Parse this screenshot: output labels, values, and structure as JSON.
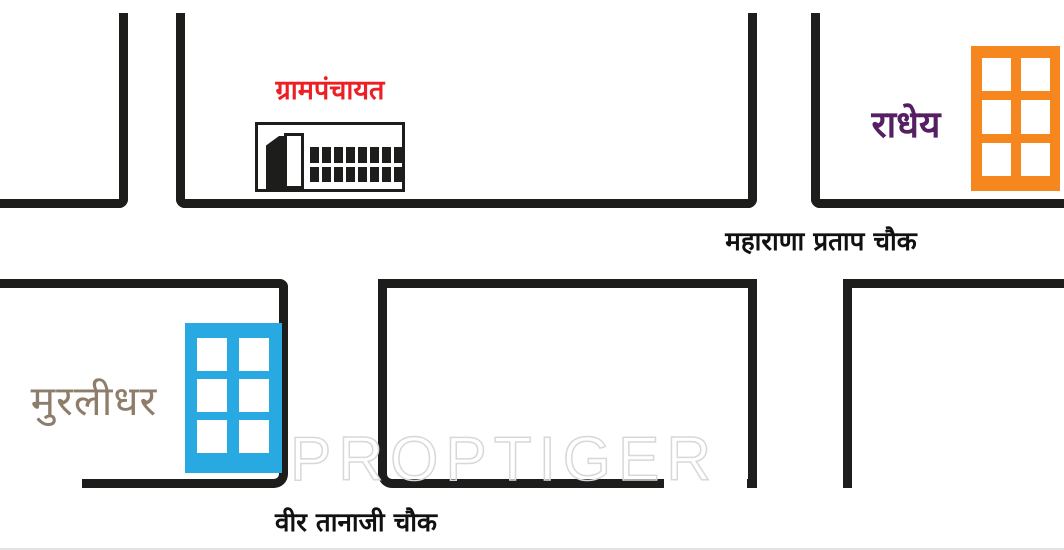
{
  "map": {
    "road_color": "#1d1d1b",
    "watermark": {
      "text": "PROPTIGER",
      "color": "#d8d8d8"
    },
    "landmarks": {
      "gram_panchayat": {
        "label": "ग्रामपंचायत",
        "label_color": "#ec2024"
      },
      "radhey": {
        "label": "राधेय",
        "label_color": "#571f63",
        "building_color": "#f6871f"
      },
      "murlidhar": {
        "label": "मुरलीधर",
        "label_color": "#8d7d6a",
        "building_color": "#29a9e1"
      }
    },
    "junctions": {
      "maharana_pratap_chowk": {
        "label": "महाराणा प्रताप चौक",
        "color": "#111111"
      },
      "veer_tanaji_chowk": {
        "label": "वीर तानाजी चौक",
        "color": "#111111"
      }
    }
  }
}
